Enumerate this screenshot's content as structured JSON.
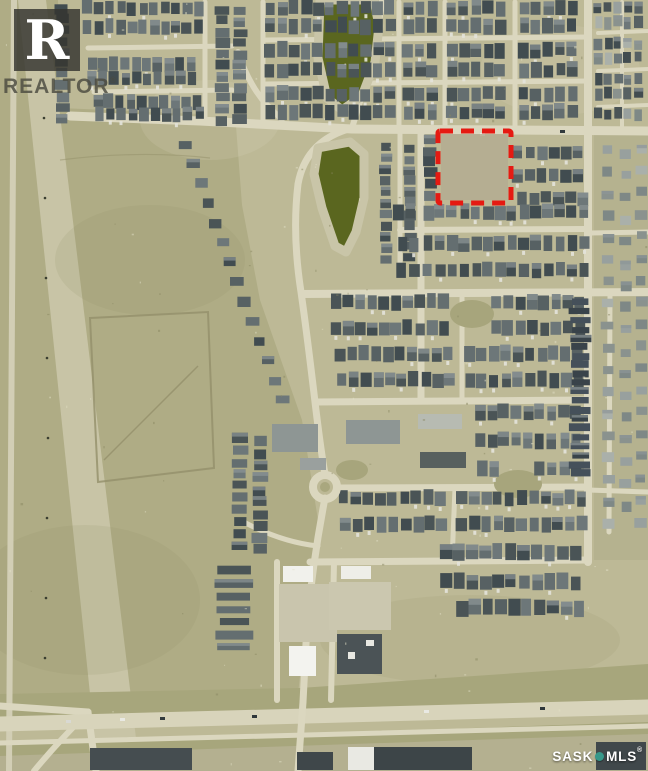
{
  "image": {
    "kind": "aerial-satellite-photo",
    "width_px": 648,
    "height_px": 771
  },
  "watermarks": {
    "realtor": {
      "logo_letter": "R",
      "label": "REALTOR",
      "registered": "®"
    },
    "sask_mls": {
      "brand_left": "SASK",
      "brand_right": "MLS",
      "registered": "®"
    }
  },
  "highlight": {
    "shape": "dashed-rectangle",
    "x": 438,
    "y": 131,
    "width": 73,
    "height": 72,
    "color": "#e51a12"
  },
  "palette": {
    "terrain_base": "#bdb996",
    "field": "#afac85",
    "corridor": "#c8c4a6",
    "road": "#dbd7bf",
    "highway": "#d8d4bb",
    "verge": "#a7a67c",
    "ground_south": "#b4b090",
    "pond": "#5a661f",
    "pond_shore": "#c9c5a8",
    "park": "#a7a57c",
    "house_dark": [
      "#4a5456",
      "#576163",
      "#646e70",
      "#414c50",
      "#6d7779"
    ],
    "house_light": [
      "#7e8886",
      "#98a09e",
      "#8a928e",
      "#aab0aa"
    ],
    "rowhouse": [
      "#39434a",
      "#45505a"
    ],
    "building_light": "#f1f1ec",
    "building_dark": "#454d50",
    "highlight_red": "#e51a12",
    "mls_teal": "#37988a",
    "realtor_square": "rgba(52,52,48,0.82)",
    "realtor_text": "rgba(74,74,64,0.82)"
  },
  "map_data": {
    "type": "satellite",
    "features": [
      "suburban residential street grid",
      "two storm ponds upper middle",
      "vacant lot outlined with red dashed boundary",
      "divided highway across the bottom",
      "commercial buildings along the highway",
      "open field and utility corridor on the west side",
      "roundabout on central collector street"
    ]
  }
}
